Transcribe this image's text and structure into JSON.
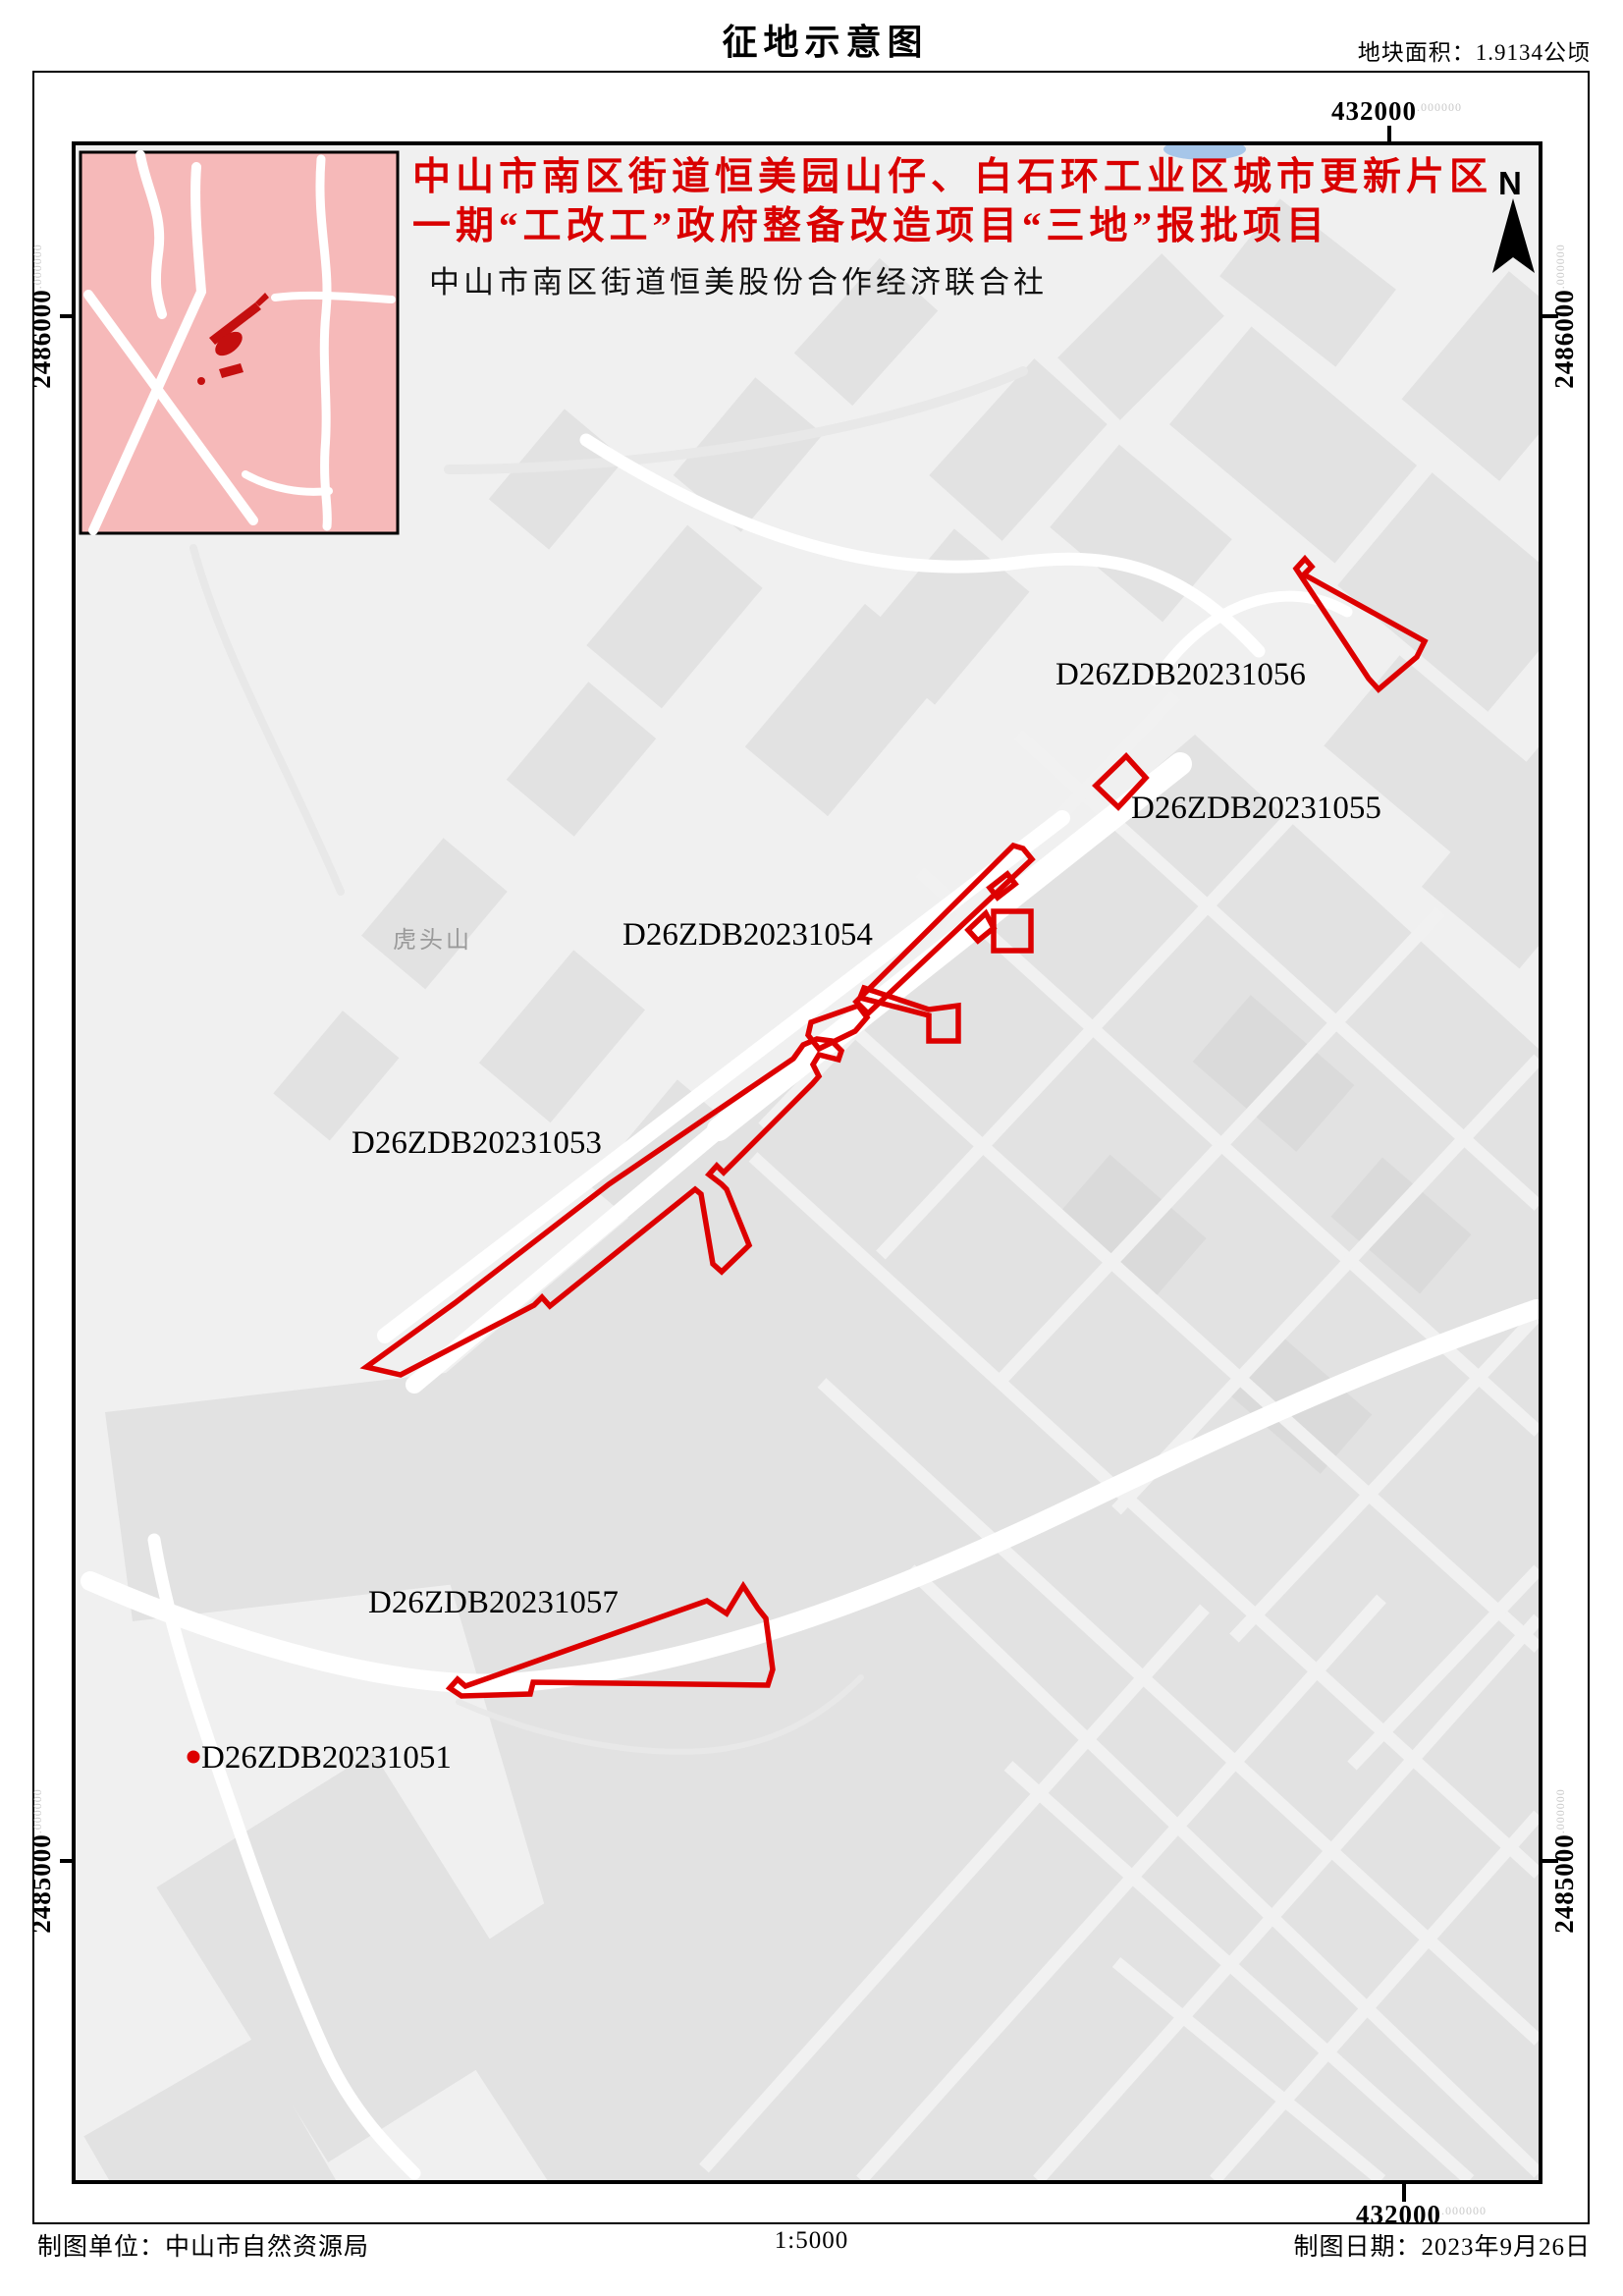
{
  "page": {
    "title": "征地示意图",
    "area_label": "地块面积：1.9134公顷"
  },
  "title_block": {
    "line1": "中山市南区街道恒美园山仔、白石环工业区城市更新片区",
    "line2": "一期“工改工”政府整备改造项目“三地”报批项目",
    "applicant": "中山市南区街道恒美股份合作经济联合社"
  },
  "map": {
    "north_label": "N",
    "place_label": "虎头山",
    "parcel_labels": {
      "p1056": "D26ZDB20231056",
      "p1055": "D26ZDB20231055",
      "p1054": "D26ZDB20231054",
      "p1053": "D26ZDB20231053",
      "p1057": "D26ZDB20231057",
      "p1051": "D26ZDB20231051"
    },
    "coords": {
      "suffix": ".000000",
      "top": "432000",
      "bottom": "432000",
      "left_top": "2486000",
      "left_bottom": "2485000",
      "right_top": "2486000",
      "right_bottom": "2485000"
    }
  },
  "footer": {
    "agency": "制图单位：中山市自然资源局",
    "scale": "1:5000",
    "date": "制图日期：2023年9月26日"
  },
  "colors": {
    "parcel": "#dd0000",
    "title_red": "#d90000",
    "inset_bg": "#f6b9b9",
    "inset_mark": "#c40f0f",
    "building": "#e2e2e2",
    "map_bg": "#f0f0f0",
    "road": "#ffffff",
    "water": "#a6c6e9",
    "place": "#9a9a9a",
    "coord_suffix": "#c8c8c8"
  }
}
